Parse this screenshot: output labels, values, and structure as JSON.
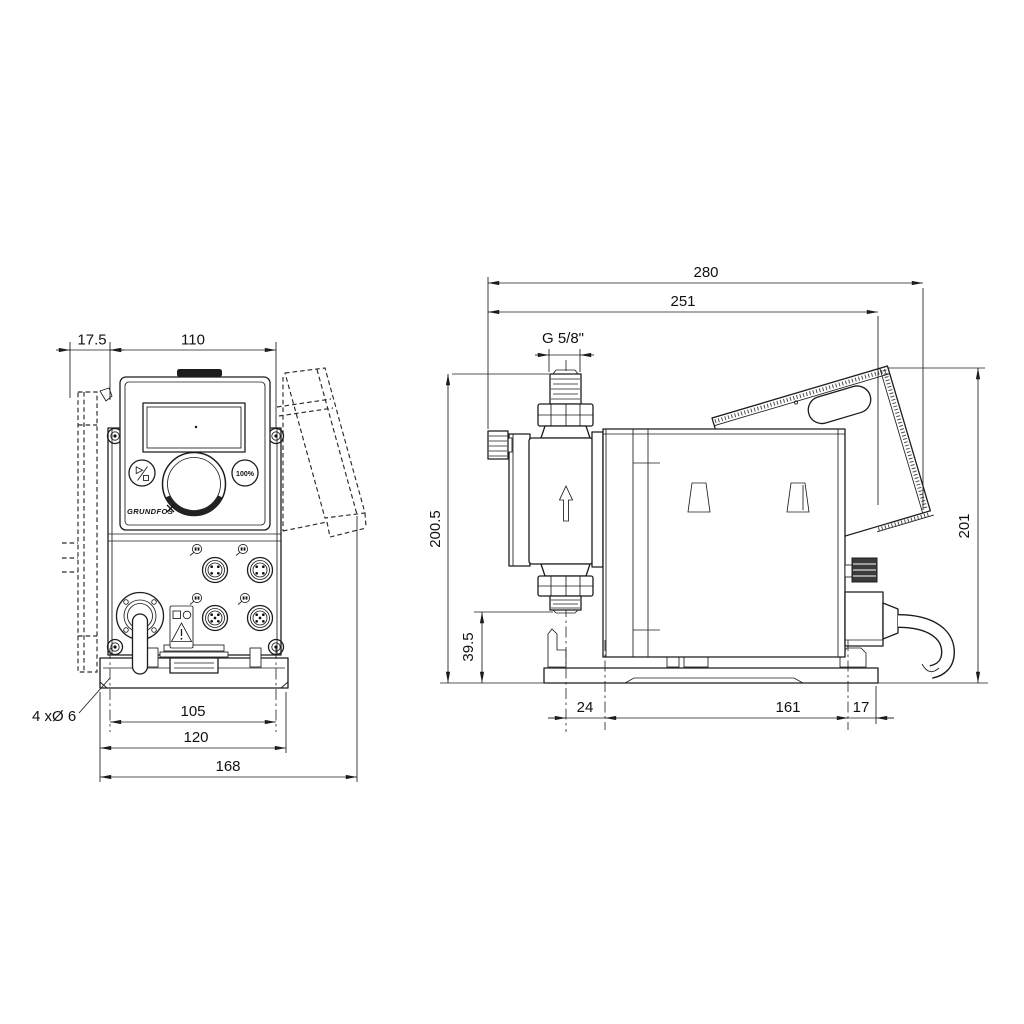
{
  "front_view": {
    "dims": {
      "wall_offset": "17.5",
      "panel_width": "110",
      "hole_spacing": "105",
      "plate_width": "120",
      "overall_width": "168"
    },
    "mounting_holes_label": "4 xØ 6",
    "panel": {
      "button_100_label": "100%",
      "logo_text": "GRUNDFOS"
    }
  },
  "side_view": {
    "dims": {
      "overall_depth": "280",
      "body_depth": "251",
      "thread": "G 5/8\"",
      "height_to_suction": "200.5",
      "suction_valve_height": "39.5",
      "overall_height": "201",
      "head_to_hole": "24",
      "hole_spacing": "161",
      "hole_to_rear": "17"
    }
  }
}
